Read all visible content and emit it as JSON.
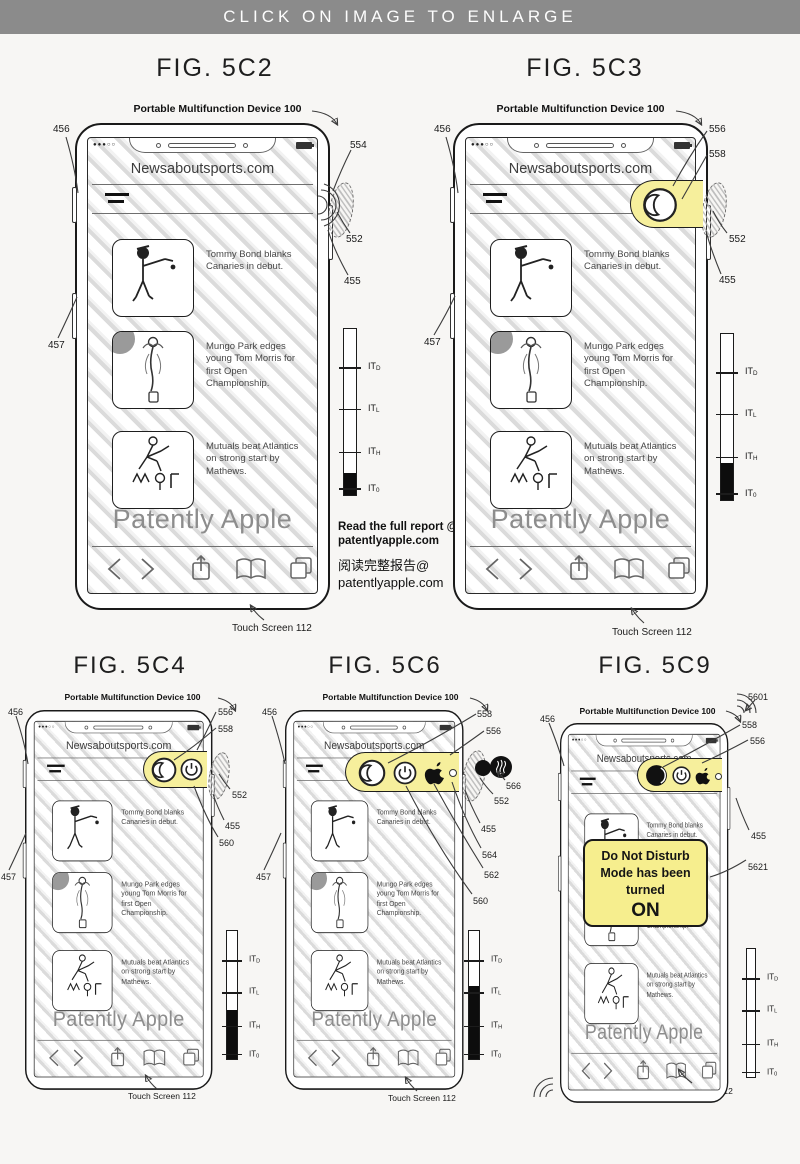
{
  "banner": {
    "label": "CLICK ON IMAGE TO ENLARGE"
  },
  "shared": {
    "device_label": "Portable Multifunction Device 100",
    "site_title": "Newsaboutsports.com",
    "watermark": "Patently Apple",
    "touch_screen_label": "Touch Screen 112",
    "it_prefix": "IT",
    "thermo_subs": [
      "D",
      "L",
      "H",
      "0"
    ],
    "signal_dots": "●●●○○",
    "news": [
      {
        "text": "Tommy Bond blanks Canaries in debut."
      },
      {
        "text": "Mungo Park edges young Tom Morris for first Open Championship."
      },
      {
        "text": "Mutuals beat Atlantics on strong start by Mathews."
      }
    ]
  },
  "report_note": {
    "en1": "Read the full report @",
    "en2": "patentlyapple.com",
    "zh1": "阅读完整报告@",
    "zh2": "patentlyapple.com"
  },
  "dnd": {
    "line1": "Do Not Disturb",
    "line2": "Mode has been",
    "line3": "turned",
    "line4": "ON"
  },
  "figures": {
    "f5c2": {
      "title": "FIG. 5C2",
      "callouts": {
        "left_upper": "456",
        "left_lower": "457",
        "speaker": "554",
        "region": "552",
        "side_button": "455"
      }
    },
    "f5c3": {
      "title": "FIG. 5C3",
      "callouts": {
        "left_upper": "456",
        "left_lower": "457",
        "panel": "556",
        "moon": "558",
        "region": "552",
        "side_button": "455"
      }
    },
    "f5c4": {
      "title": "FIG. 5C4",
      "callouts": {
        "left_upper": "456",
        "left_lower": "457",
        "panel": "556",
        "moon": "558",
        "region": "552",
        "side_button": "455",
        "power": "560"
      }
    },
    "f5c6": {
      "title": "FIG. 5C6",
      "callouts": {
        "left_upper": "456",
        "left_lower": "457",
        "moon": "558",
        "panel": "556",
        "speaker": "566",
        "region": "552",
        "side_button": "455",
        "status_dot": "564",
        "apple": "562",
        "power": "560"
      }
    },
    "f5c9": {
      "title": "FIG. 5C9",
      "callouts": {
        "left_upper": "456",
        "waves": "5601",
        "moon": "558",
        "panel": "556",
        "side_button": "455",
        "toast": "5621"
      }
    }
  }
}
